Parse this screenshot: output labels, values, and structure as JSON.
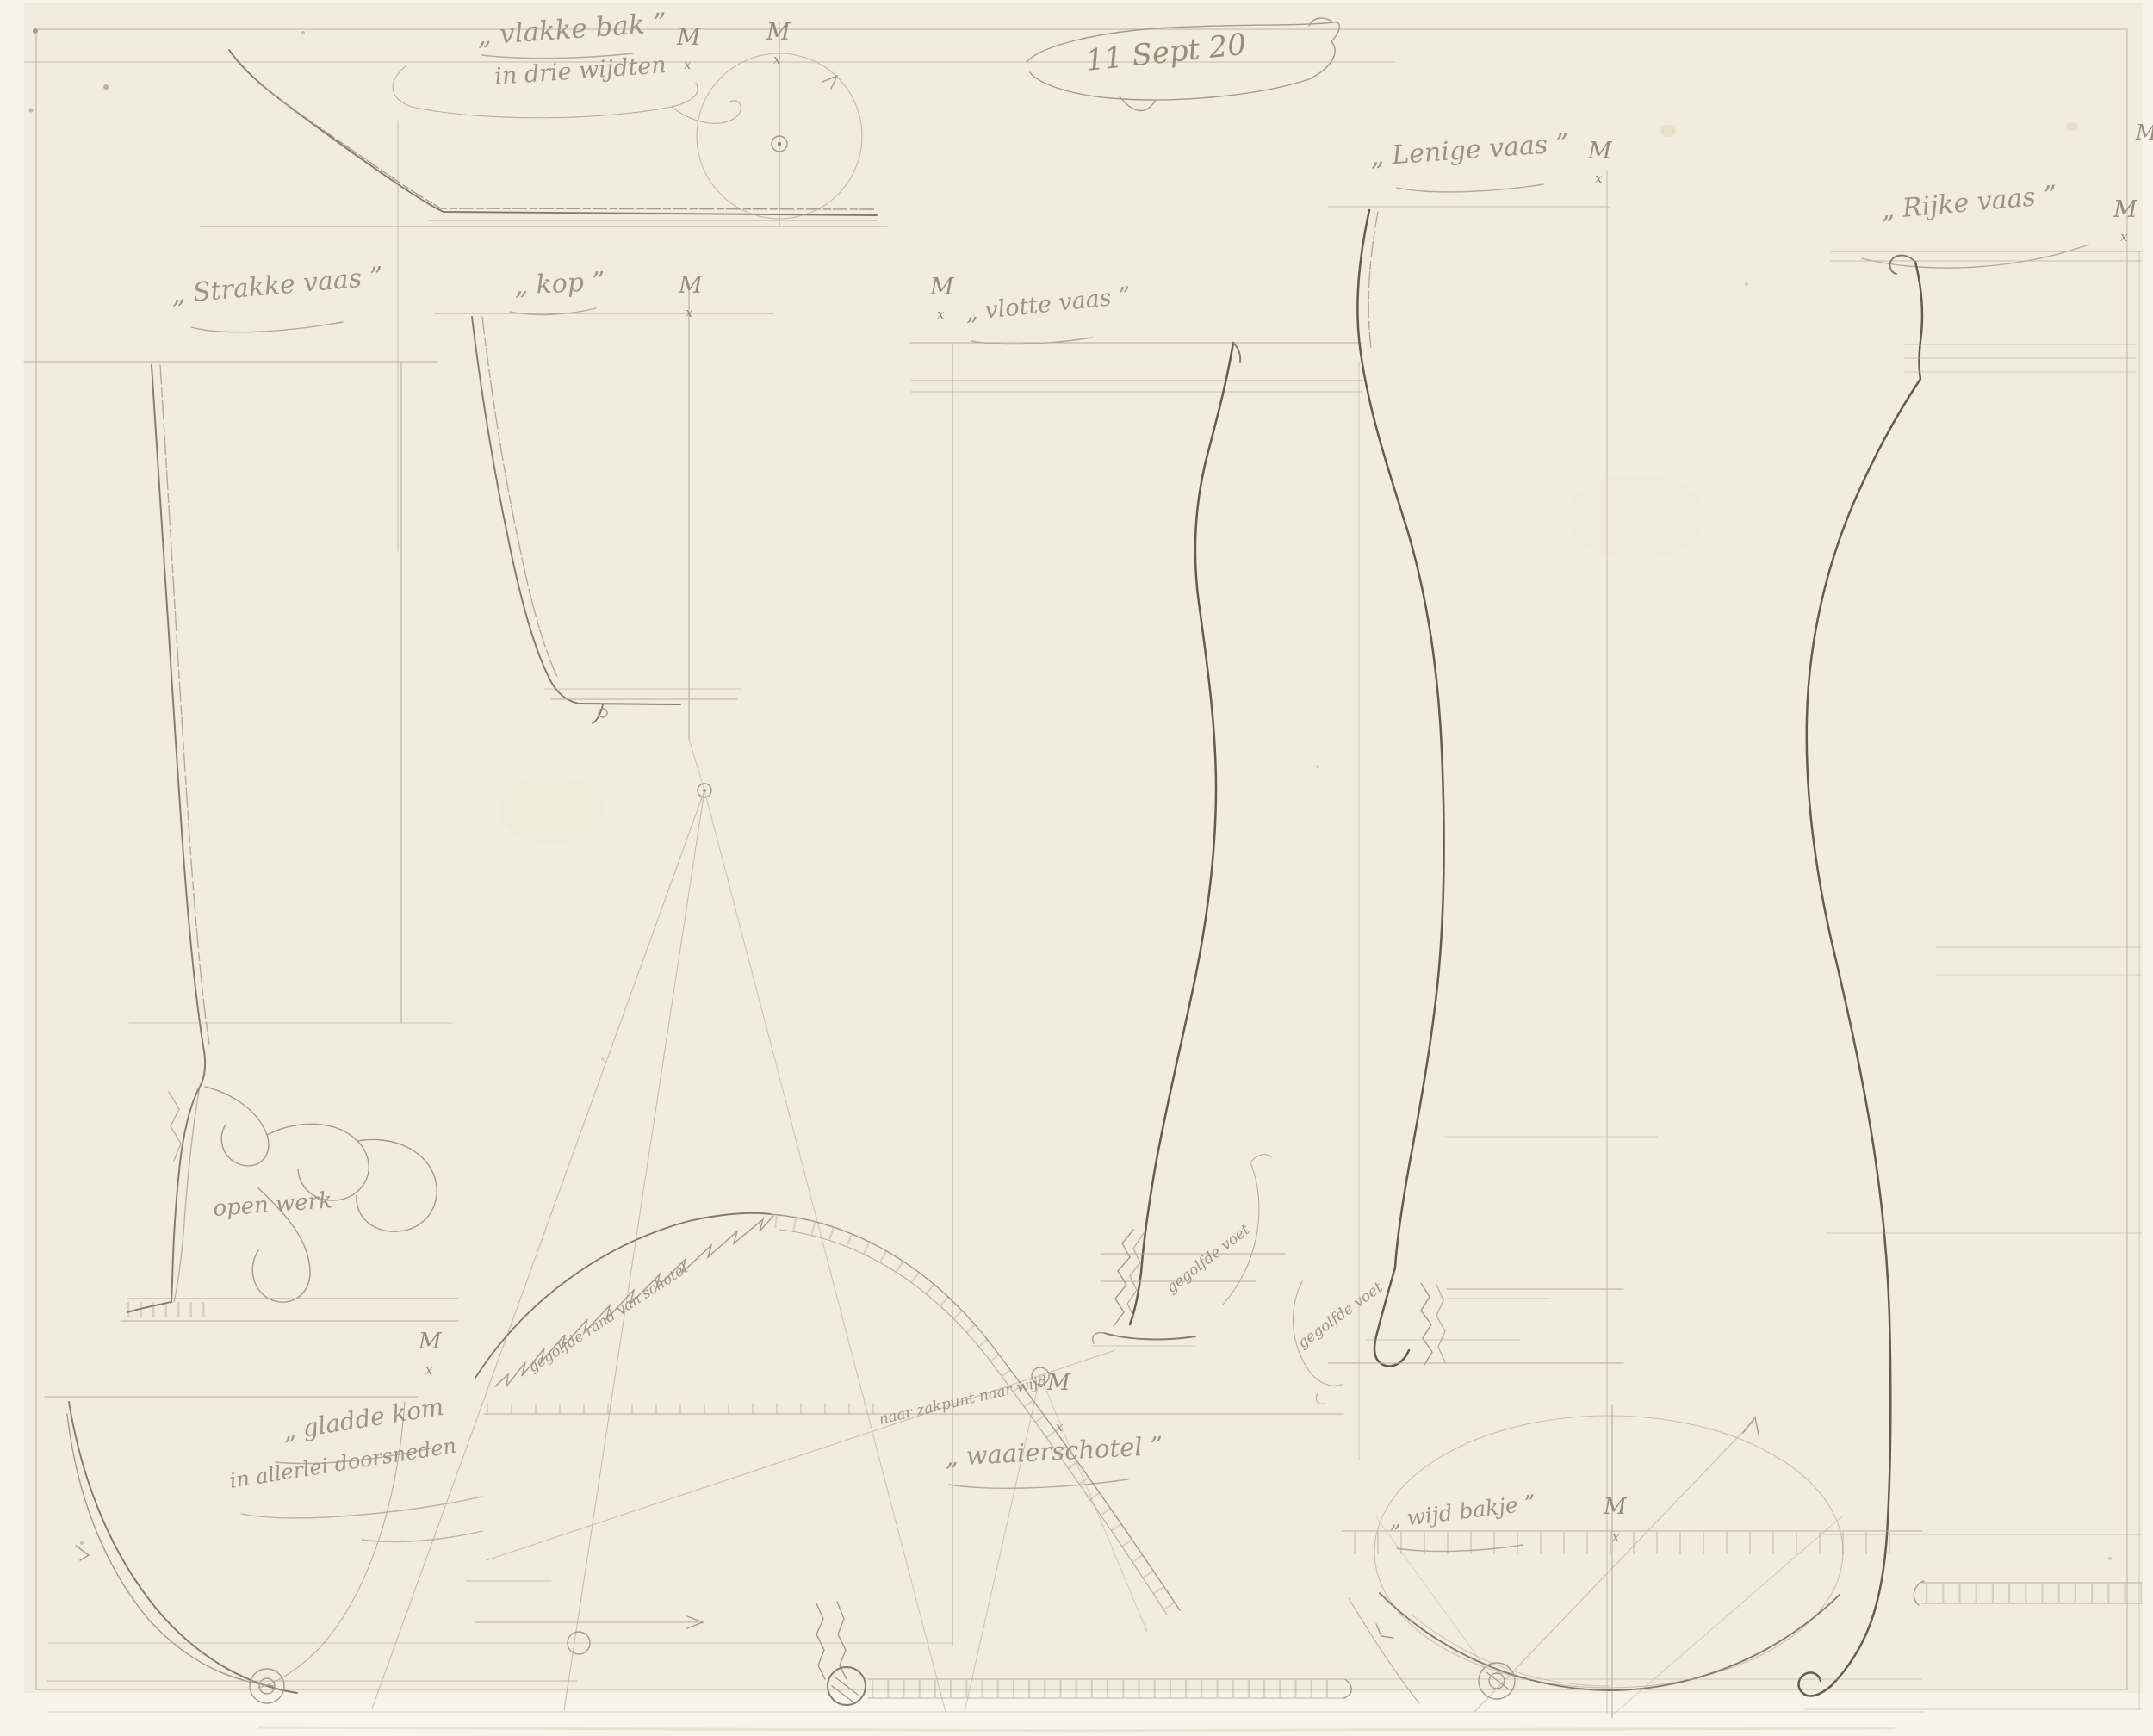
{
  "artwork": {
    "date_inscription": "11 Sept 20",
    "medium_colors": {
      "paper": "#f1ecde",
      "scan_margin": "#f7f5eb",
      "pencil_light": "#b6ae9d",
      "pencil_mid": "#847b69",
      "pencil_dark": "#645d4f",
      "handwriting": "#968d7b"
    }
  },
  "inscriptions": {
    "date": "11 Sept 20",
    "vlakke_bak": {
      "title": "„ vlakke bak ”",
      "subtitle": "in drie wijdten"
    },
    "strakke_vaas": {
      "title": "„ Strakke vaas ”"
    },
    "kop": {
      "title": "„ kop ”"
    },
    "vlotte_vaas": {
      "title": "„ vlotte vaas ”"
    },
    "lenige_vaas": {
      "title": "„ Lenige vaas ”"
    },
    "rijke_vaas": {
      "title": "„ Rijke vaas ”"
    },
    "gladde_kom": {
      "title": "„ gladde kom",
      "subtitle": "in allerlei doorsneden"
    },
    "waaierschotel": {
      "title": "„ waaierschotel ”"
    },
    "wijd_bakje": {
      "title": "„ wijd bakje ”"
    },
    "annotations": {
      "open_werk": "open werk",
      "gegolfde_voet": "gegolfde voet",
      "gegolfde_rand": "gegolfde rand van schotel",
      "zakpunt": "naar zakpunt naar wijd"
    },
    "marks": {
      "m": "M",
      "x": "x"
    }
  }
}
